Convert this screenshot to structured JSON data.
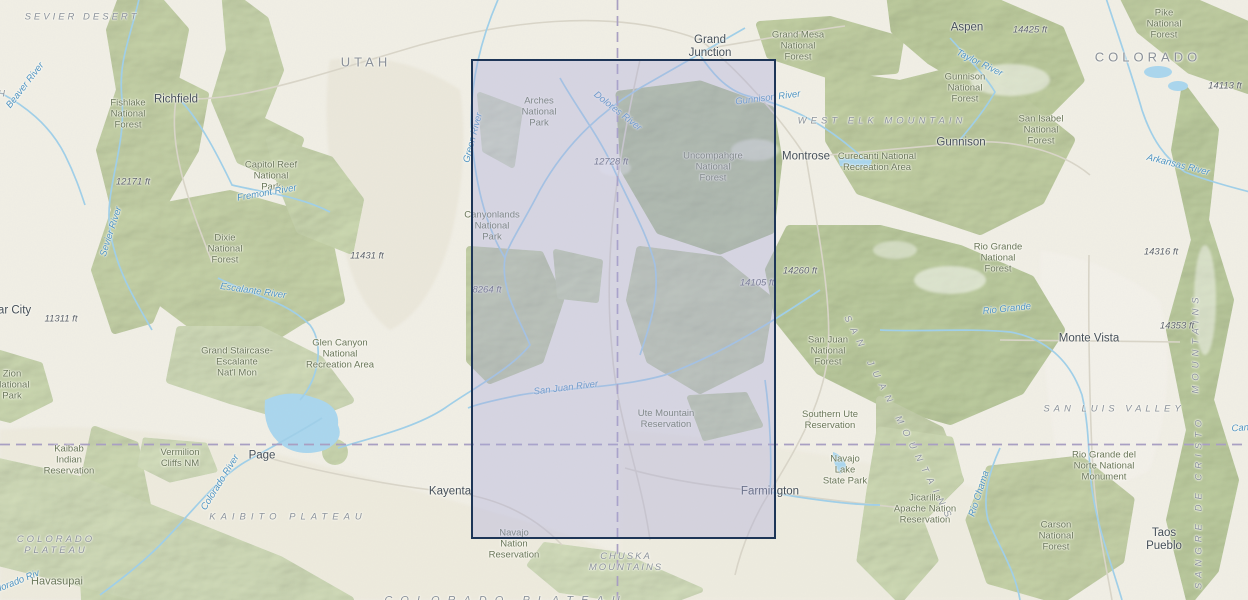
{
  "map": {
    "selection": {
      "x": 471,
      "y": 59,
      "width": 305,
      "height": 480
    },
    "colors": {
      "land": "#f1efe6",
      "forest_light": "#dde6c6",
      "forest": "#cfdcb2",
      "forest_dark": "#c3d3a4",
      "water": "#a9d6ee",
      "road": "#dcd8cb",
      "state_border": "#a89ec2",
      "selection_fill": "rgba(170,172,219,0.38)",
      "selection_border": "#1d3557"
    },
    "labels": [
      {
        "id": "state-utah",
        "type": "state",
        "text": "UTAH",
        "x": 366,
        "y": 63
      },
      {
        "id": "state-colorado",
        "type": "state",
        "text": "COLORADO",
        "x": 1148,
        "y": 58
      },
      {
        "id": "city-richfield",
        "type": "city",
        "text": "Richfield",
        "x": 176,
        "y": 100
      },
      {
        "id": "city-cedar-city",
        "type": "city",
        "text": "Cedar City",
        "x": 4,
        "y": 311
      },
      {
        "id": "city-grand-junction",
        "type": "city",
        "text": "Grand\nJunction",
        "x": 710,
        "y": 47
      },
      {
        "id": "city-aspen",
        "type": "city",
        "text": "Aspen",
        "x": 967,
        "y": 28
      },
      {
        "id": "city-gunnison",
        "type": "city",
        "text": "Gunnison",
        "x": 961,
        "y": 143
      },
      {
        "id": "city-montrose",
        "type": "city",
        "text": "Montrose",
        "x": 806,
        "y": 157
      },
      {
        "id": "city-monte-vista",
        "type": "city",
        "text": "Monte Vista",
        "x": 1089,
        "y": 339
      },
      {
        "id": "city-page",
        "type": "city",
        "text": "Page",
        "x": 262,
        "y": 456
      },
      {
        "id": "city-kayenta",
        "type": "city",
        "text": "Kayenta",
        "x": 450,
        "y": 492
      },
      {
        "id": "city-farmington",
        "type": "city",
        "text": "Farmington",
        "x": 770,
        "y": 492
      },
      {
        "id": "city-taos-pueblo",
        "type": "city",
        "text": "Taos\nPueblo",
        "x": 1164,
        "y": 540
      },
      {
        "id": "area-pike-nf",
        "type": "forest",
        "text": "Pike\nNational\nForest",
        "x": 1164,
        "y": 25
      },
      {
        "id": "area-grand-mesa-nf",
        "type": "forest",
        "text": "Grand Mesa\nNational\nForest",
        "x": 798,
        "y": 47
      },
      {
        "id": "area-gunnison-nf",
        "type": "forest",
        "text": "Gunnison\nNational\nForest",
        "x": 965,
        "y": 89
      },
      {
        "id": "area-san-isabel-nf",
        "type": "forest",
        "text": "San Isabel\nNational\nForest",
        "x": 1041,
        "y": 131
      },
      {
        "id": "area-arches-np",
        "type": "forest",
        "text": "Arches\nNational\nPark",
        "x": 539,
        "y": 113
      },
      {
        "id": "area-uncompahgre-nf",
        "type": "forest",
        "text": "Uncompahgre\nNational\nForest",
        "x": 713,
        "y": 168
      },
      {
        "id": "area-fishlake-nf",
        "type": "forest",
        "text": "Fishlake\nNational\nForest",
        "x": 128,
        "y": 115
      },
      {
        "id": "area-capitol-reef-np",
        "type": "forest",
        "text": "Capitol Reef\nNational\nPark",
        "x": 271,
        "y": 177
      },
      {
        "id": "area-dixie-nf",
        "type": "forest",
        "text": "Dixie\nNational\nForest",
        "x": 225,
        "y": 250
      },
      {
        "id": "area-canyonlands-np",
        "type": "forest",
        "text": "Canyonlands\nNational\nPark",
        "x": 492,
        "y": 227
      },
      {
        "id": "area-san-juan-nf",
        "type": "forest",
        "text": "San Juan\nNational\nForest",
        "x": 828,
        "y": 352
      },
      {
        "id": "area-rio-grande-nf",
        "type": "forest",
        "text": "Rio Grande\nNational\nForest",
        "x": 998,
        "y": 259
      },
      {
        "id": "area-grand-staircase",
        "type": "forest",
        "text": "Grand Staircase-\nEscalante\nNat'l Mon",
        "x": 237,
        "y": 363
      },
      {
        "id": "area-glen-canyon-nra",
        "type": "forest",
        "text": "Glen Canyon\nNational\nRecreation Area",
        "x": 340,
        "y": 355
      },
      {
        "id": "area-curecanti-nra",
        "type": "forest",
        "text": "Curecanti National\nRecreation Area",
        "x": 877,
        "y": 163
      },
      {
        "id": "area-zion-np",
        "type": "forest",
        "text": "Zion\nNational\nPark",
        "x": 12,
        "y": 386
      },
      {
        "id": "area-kaibab-ir",
        "type": "forest",
        "text": "Kaibab\nIndian\nReservation",
        "x": 69,
        "y": 461
      },
      {
        "id": "area-vermilion-cliffs",
        "type": "forest",
        "text": "Vermilion\nCliffs NM",
        "x": 180,
        "y": 459
      },
      {
        "id": "area-ute-mountain-res",
        "type": "forest",
        "text": "Ute Mountain\nReservation",
        "x": 666,
        "y": 420
      },
      {
        "id": "area-southern-ute-res",
        "type": "forest",
        "text": "Southern Ute\nReservation",
        "x": 830,
        "y": 421
      },
      {
        "id": "area-navajo-lake-sp",
        "type": "forest",
        "text": "Navajo\nLake\nState Park",
        "x": 845,
        "y": 471
      },
      {
        "id": "area-navajo-nation-res",
        "type": "forest",
        "text": "Navajo\nNation\nReservation",
        "x": 514,
        "y": 545
      },
      {
        "id": "area-jicarilla-res",
        "type": "forest",
        "text": "Jicarilla\nApache Nation\nReservation",
        "x": 925,
        "y": 510
      },
      {
        "id": "area-carson-nf",
        "type": "forest",
        "text": "Carson\nNational\nForest",
        "x": 1056,
        "y": 537
      },
      {
        "id": "area-rio-grande-del-norte",
        "type": "forest",
        "text": "Rio Grande del\nNorte National\nMonument",
        "x": 1104,
        "y": 467
      },
      {
        "id": "area-havasupai",
        "type": "forest",
        "text": "Havasupai",
        "x": 57,
        "y": 582,
        "fs": 11
      },
      {
        "id": "physio-sevier-desert",
        "type": "physio",
        "text": "SEVIER DESERT",
        "x": 82,
        "y": 18
      },
      {
        "id": "physio-west-elk-mountain",
        "type": "physio",
        "text": "WEST ELK MOUNTAIN",
        "x": 882,
        "y": 122,
        "ls": 4
      },
      {
        "id": "physio-san-juan-mountains",
        "type": "physio",
        "text": "SAN JUAN MOUNTAINS",
        "x": 898,
        "y": 420,
        "rot": 63,
        "ls": 7
      },
      {
        "id": "physio-san-luis-valley",
        "type": "physio",
        "text": "SAN LUIS VALLEY",
        "x": 1114,
        "y": 410,
        "ls": 4
      },
      {
        "id": "physio-kaibito-plateau",
        "type": "physio",
        "text": "KAIBITO PLATEAU",
        "x": 288,
        "y": 518,
        "ls": 5
      },
      {
        "id": "physio-colorado-plateau",
        "type": "physio",
        "text": "COLORADO\nPLATEAU",
        "x": 56,
        "y": 546
      },
      {
        "id": "physio-chuska-mountains",
        "type": "physio",
        "text": "CHUSKA\nMOUNTAINS",
        "x": 626,
        "y": 563,
        "ls": 2
      },
      {
        "id": "physio-sangre-de-cristo",
        "type": "physio",
        "text": "SANGRE DE CRISTO",
        "x": 1200,
        "y": 502,
        "rot": -90,
        "ls": 5
      },
      {
        "id": "physio-sangre-mountains",
        "type": "physio",
        "text": "MOUNTAINS",
        "x": 1197,
        "y": 343,
        "rot": -90,
        "ls": 5
      },
      {
        "id": "physio-colorado-plateau-bottom",
        "type": "physio",
        "text": "COLORADO PLATEAU",
        "x": 506,
        "y": 601,
        "ls": 8,
        "fs": 11
      },
      {
        "id": "physio-h-cut",
        "type": "physio",
        "text": "H",
        "x": 3,
        "y": 95
      },
      {
        "id": "river-beaver",
        "type": "river",
        "text": "Beaver River",
        "x": 26,
        "y": 86,
        "rot": -52
      },
      {
        "id": "river-sevier",
        "type": "river",
        "text": "Sevier River",
        "x": 112,
        "y": 232,
        "rot": -72
      },
      {
        "id": "river-fremont",
        "type": "river",
        "text": "Fremont River",
        "x": 267,
        "y": 194,
        "rot": -10
      },
      {
        "id": "river-escalante",
        "type": "river",
        "text": "Escalante River",
        "x": 253,
        "y": 292,
        "rot": 8
      },
      {
        "id": "river-green",
        "type": "river",
        "text": "Green River",
        "x": 474,
        "y": 138,
        "rot": -75
      },
      {
        "id": "river-dolores",
        "type": "river",
        "text": "Dolores River",
        "x": 617,
        "y": 112,
        "rot": 38
      },
      {
        "id": "river-gunnison",
        "type": "river",
        "text": "Gunnison River",
        "x": 768,
        "y": 99,
        "rot": -7
      },
      {
        "id": "river-colorado",
        "type": "river",
        "text": "Colorado River",
        "x": 221,
        "y": 483,
        "rot": -58
      },
      {
        "id": "river-san-juan",
        "type": "river",
        "text": "San Juan River",
        "x": 566,
        "y": 389,
        "rot": -7
      },
      {
        "id": "river-rio-grande",
        "type": "river",
        "text": "Rio Grande",
        "x": 1007,
        "y": 310,
        "rot": -6
      },
      {
        "id": "river-arkansas",
        "type": "river",
        "text": "Arkansas River",
        "x": 1178,
        "y": 166,
        "rot": 14
      },
      {
        "id": "river-rio-chama",
        "type": "river",
        "text": "Rio Chama",
        "x": 980,
        "y": 494,
        "rot": -72
      },
      {
        "id": "river-taylor",
        "type": "river",
        "text": "Taylor River",
        "x": 979,
        "y": 64,
        "rot": 26
      },
      {
        "id": "river-cana-cut",
        "type": "river",
        "text": "Cana",
        "x": 1243,
        "y": 429,
        "rot": -4
      },
      {
        "id": "river-colorado-bl-cut",
        "type": "river",
        "text": "Colorado Riv",
        "x": 14,
        "y": 584,
        "rot": -22
      },
      {
        "id": "elev-12171",
        "type": "elev",
        "text": "12171 ft",
        "x": 133,
        "y": 183
      },
      {
        "id": "elev-11431",
        "type": "elev",
        "text": "11431 ft",
        "x": 367,
        "y": 257
      },
      {
        "id": "elev-11311",
        "type": "elev",
        "text": "11311 ft",
        "x": 61,
        "y": 320
      },
      {
        "id": "elev-12728",
        "type": "elev",
        "text": "12728 ft",
        "x": 611,
        "y": 163
      },
      {
        "id": "elev-8264",
        "type": "elev",
        "text": "8264 ft",
        "x": 487,
        "y": 291
      },
      {
        "id": "elev-14105",
        "type": "elev",
        "text": "14105 ft",
        "x": 757,
        "y": 284
      },
      {
        "id": "elev-14260",
        "type": "elev",
        "text": "14260 ft",
        "x": 800,
        "y": 272
      },
      {
        "id": "elev-14425",
        "type": "elev",
        "text": "14425 ft",
        "x": 1030,
        "y": 31
      },
      {
        "id": "elev-14113",
        "type": "elev",
        "text": "14113 ft",
        "x": 1225,
        "y": 87
      },
      {
        "id": "elev-14316",
        "type": "elev",
        "text": "14316 ft",
        "x": 1161,
        "y": 253
      },
      {
        "id": "elev-14353",
        "type": "elev",
        "text": "14353 ft",
        "x": 1177,
        "y": 327
      }
    ]
  }
}
